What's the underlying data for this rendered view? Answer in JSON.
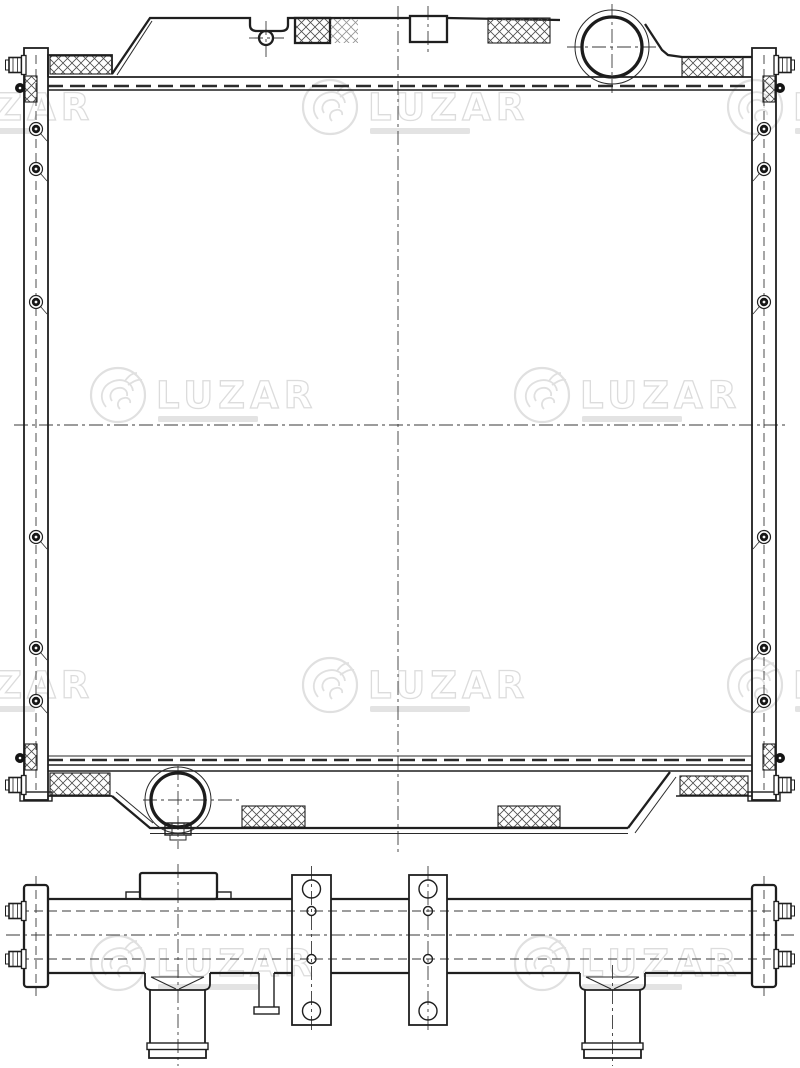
{
  "watermarks": {
    "brand": "LUZAR"
  },
  "colors": {
    "background": "#ffffff",
    "line": "#1f1f1f",
    "centerline": "#3a3a3a",
    "hatch": "#4d4d4d",
    "watermark": "#e0e0e0"
  }
}
